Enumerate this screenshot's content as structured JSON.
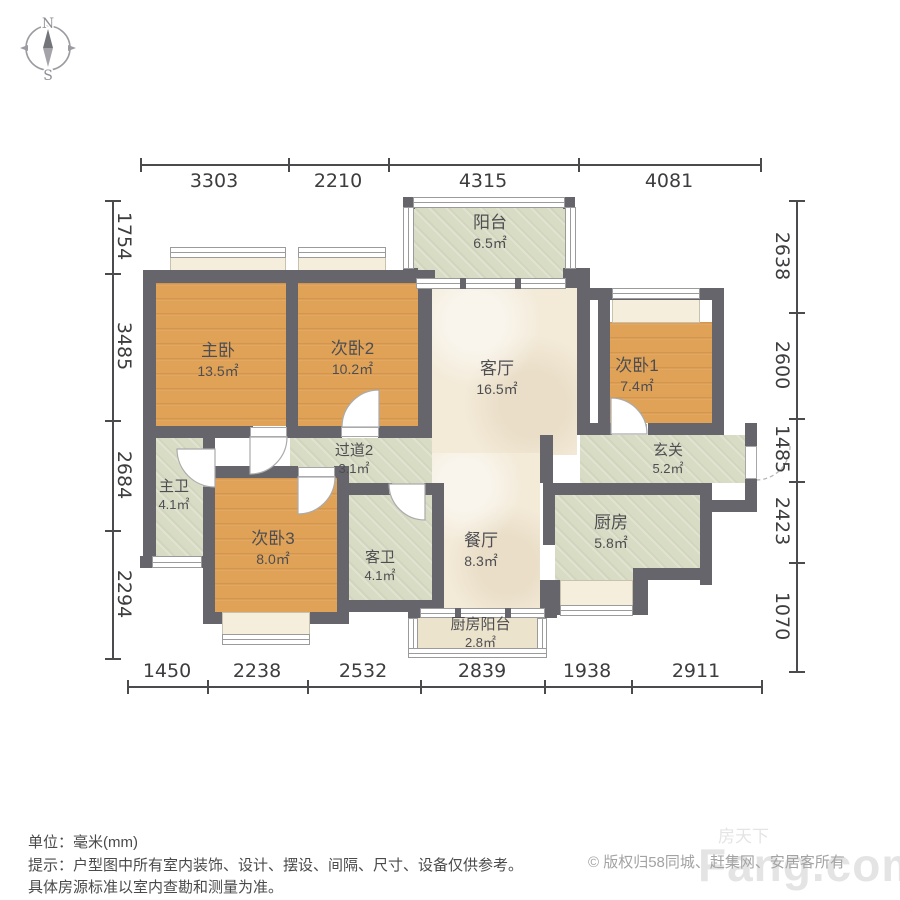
{
  "compass": {
    "north_label": "N",
    "south_label": "S"
  },
  "dimensions": {
    "top": [
      "3303",
      "2210",
      "4315",
      "4081"
    ],
    "bottom": [
      "1450",
      "2238",
      "2532",
      "2839",
      "1938",
      "2911"
    ],
    "left": [
      "1754",
      "3485",
      "2684",
      "2294"
    ],
    "right": [
      "2638",
      "2600",
      "1485",
      "2423",
      "1070"
    ]
  },
  "rooms": [
    {
      "name": "阳台",
      "area": "6.5㎡"
    },
    {
      "name": "主卧",
      "area": "13.5㎡"
    },
    {
      "name": "次卧2",
      "area": "10.2㎡"
    },
    {
      "name": "客厅",
      "area": "16.5㎡"
    },
    {
      "name": "次卧1",
      "area": "7.4㎡"
    },
    {
      "name": "过道2",
      "area": "3.1㎡"
    },
    {
      "name": "玄关",
      "area": "5.2㎡"
    },
    {
      "name": "主卫",
      "area": "4.1㎡"
    },
    {
      "name": "次卧3",
      "area": "8.0㎡"
    },
    {
      "name": "客卫",
      "area": "4.1㎡"
    },
    {
      "name": "餐厅",
      "area": "8.3㎡"
    },
    {
      "name": "厨房",
      "area": "5.8㎡"
    },
    {
      "name": "厨房阳台",
      "area": "2.8㎡"
    }
  ],
  "footer": {
    "unit_line": "单位：毫米(mm)",
    "tip_line1": "提示：户型图中所有室内装饰、设计、摆设、间隔、尺寸、设备仅供参考。",
    "tip_line2": "具体房源标准以室内查勘和测量为准。",
    "copyright": "© 版权归58同城、赶集网、安居客所有"
  },
  "watermark": {
    "text_en": "Fang.com",
    "text_cn": "房天下"
  },
  "colors": {
    "wall": "#65656b",
    "wood": "#e0a257",
    "tile": "#d9dcc4",
    "marble": "#f3ead8",
    "bay_seat": "#f6eedc"
  }
}
